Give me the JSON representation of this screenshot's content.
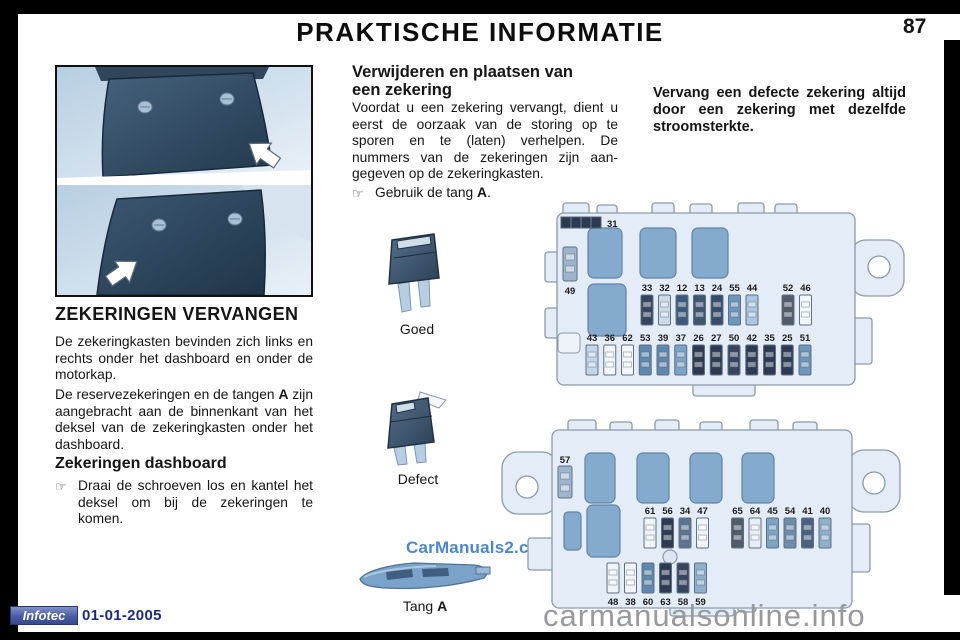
{
  "header": {
    "title": "PRAKTISCHE INFORMATIE",
    "page_number": "87"
  },
  "left_column": {
    "section1_title": "ZEKERINGEN VERVANGEN",
    "para1": "De zekeringkasten bevinden zich links en rechts onder het dashboard en onder de motorkap.",
    "para2_prefix": "De reservezekeringen en de tangen ",
    "para2_bold": "A",
    "para2_suffix": " zijn aangebracht aan de binnenkant van het deksel van de zekeringkasten onder het dashboard.",
    "section2_title": "Zekeringen dashboard",
    "bullet_icon": "☞",
    "bullet_text": "Draai de schroeven los en kantel het deksel om bij de zekeringen te komen."
  },
  "middle_column": {
    "section_title": "Verwijderen en plaatsen van een zekering",
    "para": "Voordat u een zekering vervangt, dient u eerst de oorzaak van de storing op te sporen en te (laten) verhelpen. De nummers van de zekeringen zijn aan-gegeven op de zekeringkasten.",
    "bullet_icon": "☞",
    "bullet_prefix": "Gebruik de tang ",
    "bullet_bold": "A",
    "bullet_suffix": ".",
    "fuse_good_label": "Goed",
    "fuse_defect_label": "Defect",
    "tool_label_prefix": "Tang ",
    "tool_label_bold": "A"
  },
  "right_column": {
    "warning": "Vervang een defecte zekering altijd door een zekering met dezelfde stroomsterkte."
  },
  "fusebox_upper": {
    "strip_fuse_label": "31",
    "side_fuse_label": "49",
    "row1": [
      {
        "n": "33",
        "c": "#36445e"
      },
      {
        "n": "32",
        "c": "#ccd9e8"
      },
      {
        "n": "12",
        "c": "#3c5a7d"
      },
      {
        "n": "13",
        "c": "#40566f"
      },
      {
        "n": "24",
        "c": "#384c68"
      },
      {
        "n": "55",
        "c": "#6e96ba"
      },
      {
        "n": "44",
        "c": "#aac6e0"
      },
      {
        "n": "52",
        "c": "#515c6b",
        "gap_before": true
      },
      {
        "n": "46",
        "c": "#f3f6fa"
      }
    ],
    "row2": [
      {
        "n": "43",
        "c": "#c2d6e8"
      },
      {
        "n": "36",
        "c": "#f3f6fa"
      },
      {
        "n": "62",
        "c": "#f3f6fa"
      },
      {
        "n": "53",
        "c": "#5e88ae"
      },
      {
        "n": "39",
        "c": "#5e88ae"
      },
      {
        "n": "37",
        "c": "#7aa3c4"
      },
      {
        "n": "26",
        "c": "#2d3a50"
      },
      {
        "n": "27",
        "c": "#2d3a50"
      },
      {
        "n": "50",
        "c": "#36445e"
      },
      {
        "n": "42",
        "c": "#2d3a50"
      },
      {
        "n": "35",
        "c": "#2d3a50"
      },
      {
        "n": "25",
        "c": "#2d3a50"
      },
      {
        "n": "51",
        "c": "#6e96ba"
      }
    ]
  },
  "fusebox_lower": {
    "side_fuse_label": "57",
    "row1": [
      {
        "n": "61",
        "c": "#f0f4f9"
      },
      {
        "n": "56",
        "c": "#2d3a50"
      },
      {
        "n": "34",
        "c": "#5e7390"
      },
      {
        "n": "47",
        "c": "#f0f4f9"
      },
      {
        "n": "65",
        "c": "#515c6b",
        "gap_before": true
      },
      {
        "n": "64",
        "c": "#e8eef5"
      },
      {
        "n": "45",
        "c": "#7aa3c4"
      },
      {
        "n": "54",
        "c": "#6e8cab"
      },
      {
        "n": "41",
        "c": "#49617e"
      },
      {
        "n": "40",
        "c": "#8fb0ca"
      }
    ],
    "row2": [
      {
        "n": "48",
        "c": "#f0f4f9"
      },
      {
        "n": "38",
        "c": "#f0f4f9"
      },
      {
        "n": "60",
        "c": "#5e88ae"
      },
      {
        "n": "63",
        "c": "#2d3a50"
      },
      {
        "n": "58",
        "c": "#36445e"
      },
      {
        "n": "59",
        "c": "#8fb0ca"
      }
    ]
  },
  "footer": {
    "logo": "Infotec",
    "date": "01-01-2005"
  },
  "watermarks": {
    "middle": "CarManuals2.com",
    "bottom": "carmanualsonline.info"
  },
  "colors": {
    "fusebox_body": "#e4edf7",
    "fusebox_stroke": "#8a9aa8",
    "relay_fill": "#84abce",
    "accent_blue": "#1b2a80",
    "watermark_blue": "#3f7cc9",
    "watermark_gray": "#97999c"
  }
}
